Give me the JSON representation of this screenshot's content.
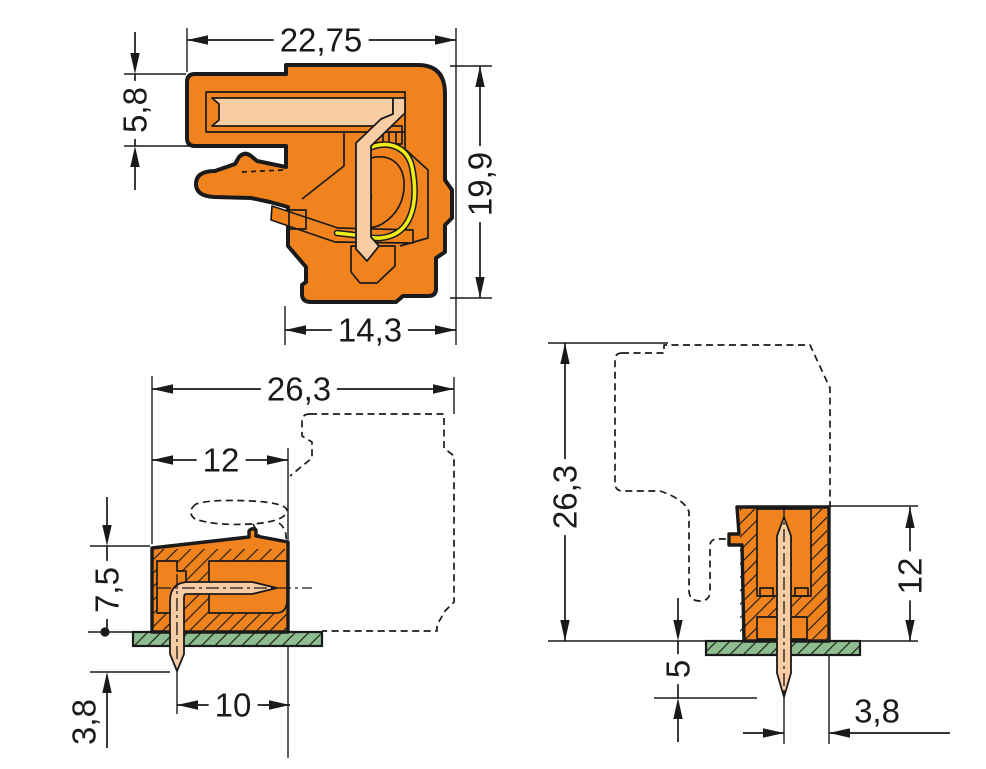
{
  "colors": {
    "orange": "#f0831e",
    "peach": "#f9cda3",
    "yellow": "#f0ec1a",
    "pcb_green": "#8ebd90",
    "ink": "#1a1a1a",
    "background": "#ffffff"
  },
  "views": {
    "angled_section": {
      "dim_total_width": "22,75",
      "dim_entry_height": "5,8",
      "dim_total_height": "19,9",
      "dim_body_width": "14,3"
    },
    "side_view_on_pcb": {
      "dim_total_depth": "26,3",
      "dim_header_depth": "12",
      "dim_height_above_pcb": "7,5",
      "dim_pin_length_below_pcb": "3,8",
      "dim_pin_to_face": "10"
    },
    "front_view_on_pcb": {
      "dim_total_height": "26,3",
      "dim_header_height": "12",
      "dim_pin_length_below_pcb": "5",
      "dim_pin_to_edge": "3,8"
    }
  }
}
